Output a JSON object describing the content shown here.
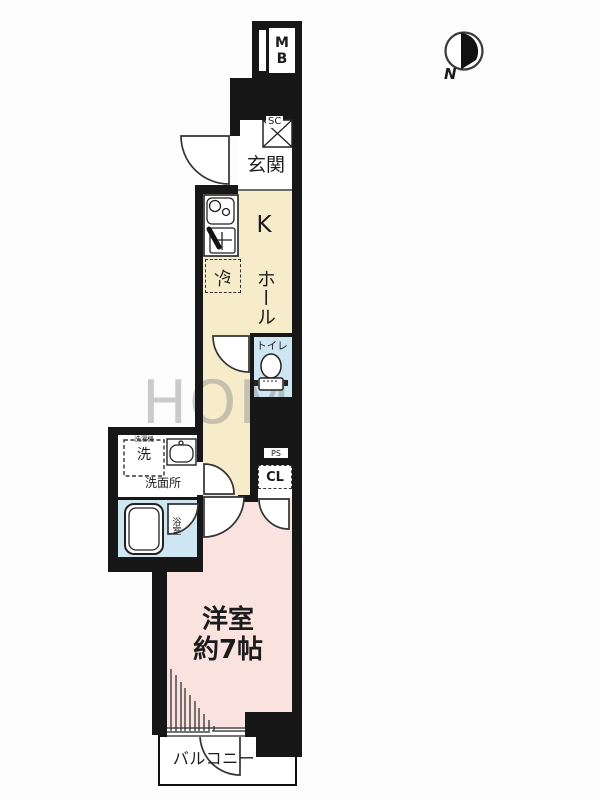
{
  "compass": {
    "label": "N"
  },
  "watermark": {
    "text": "HOM"
  },
  "labels": {
    "meter_box": "MB",
    "shoe_closet": "SC",
    "entrance": "玄関",
    "kitchen": "K",
    "hall": "ホール",
    "refrigerator": "冷",
    "toilet": "トイレ",
    "washing_machine": "洗",
    "washing_machine_small": "洗濯機",
    "washroom": "洗面所",
    "bathroom": "浴室",
    "pipe_space": "PS",
    "closet": "CL",
    "main_room_name": "洋室",
    "main_room_size": "約7帖",
    "balcony": "バルコニー"
  },
  "colors": {
    "wall": "#171717",
    "kitchen_hall_floor": "#f6ecca",
    "main_room_floor": "#fae3de",
    "wet_area_floor": "#cee6f2",
    "background": "#fdfdfd",
    "watermark_gray": "#8c8c8c"
  }
}
